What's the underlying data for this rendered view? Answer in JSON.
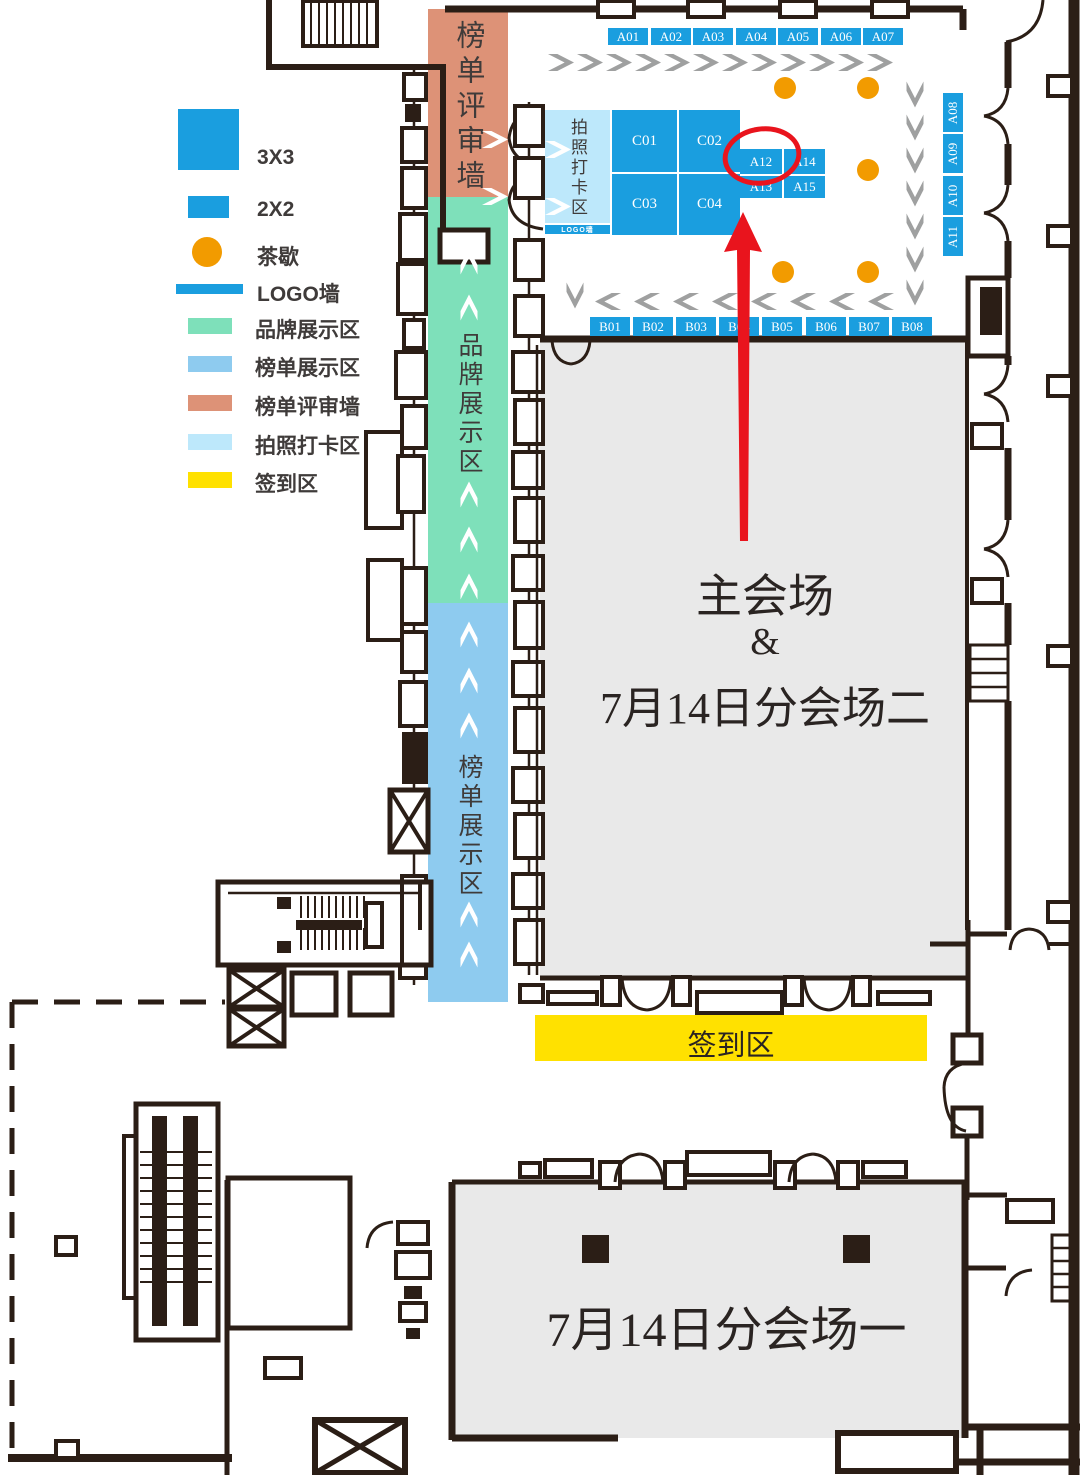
{
  "annotation": {
    "highlighted_booth": "A12"
  },
  "colors": {
    "booth_blue": "#1A9EDF",
    "brand_green": "#7EE0BA",
    "list_blue": "#8ECBEF",
    "review_salmon": "#DD9277",
    "photo_lightblue": "#BDE8FB",
    "signin_yellow": "#FFE100",
    "tea_orange": "#F29B00",
    "hall_gray": "#E9E9E9",
    "wall_dark": "#2B1E16",
    "flow_gray": "#9FA0A0",
    "annotation_red": "#E9141D"
  },
  "legend": {
    "items": [
      {
        "key": "booth-3x3",
        "label": "3X3"
      },
      {
        "key": "booth-2x2",
        "label": "2X2"
      },
      {
        "key": "tea-break",
        "label": "茶歇"
      },
      {
        "key": "logo-wall",
        "label": "LOGO墙"
      },
      {
        "key": "brand-area",
        "label": "品牌展示区"
      },
      {
        "key": "list-area",
        "label": "榜单展示区"
      },
      {
        "key": "review-wall",
        "label": "榜单评审墙"
      },
      {
        "key": "photo-area",
        "label": "拍照打卡区"
      },
      {
        "key": "signin-area",
        "label": "签到区"
      }
    ]
  },
  "zones": {
    "review_wall_label": "榜单评审墙",
    "brand_area_label": "品牌展示区",
    "list_area_label": "榜单展示区",
    "photo_area_label": "拍照打卡区",
    "logo_wall_label": "LOGO墙",
    "signin_label": "签到区"
  },
  "halls": {
    "main_line1": "主会场",
    "main_line2": "&",
    "main_line3": "7月14日分会场二",
    "sub_hall_label": "7月14日分会场一"
  },
  "booths": {
    "a_top": [
      "A01",
      "A02",
      "A03",
      "A04",
      "A05",
      "A06",
      "A07"
    ],
    "a_right": [
      "A08",
      "A09",
      "A10",
      "A11"
    ],
    "island_row1": [
      "A12",
      "A14"
    ],
    "island_row2": [
      "A13",
      "A15"
    ],
    "b_row": [
      "B01",
      "B02",
      "B03",
      "B04",
      "B05",
      "B06",
      "B07",
      "B08"
    ],
    "c_block": [
      "C01",
      "C02",
      "C03",
      "C04"
    ]
  }
}
